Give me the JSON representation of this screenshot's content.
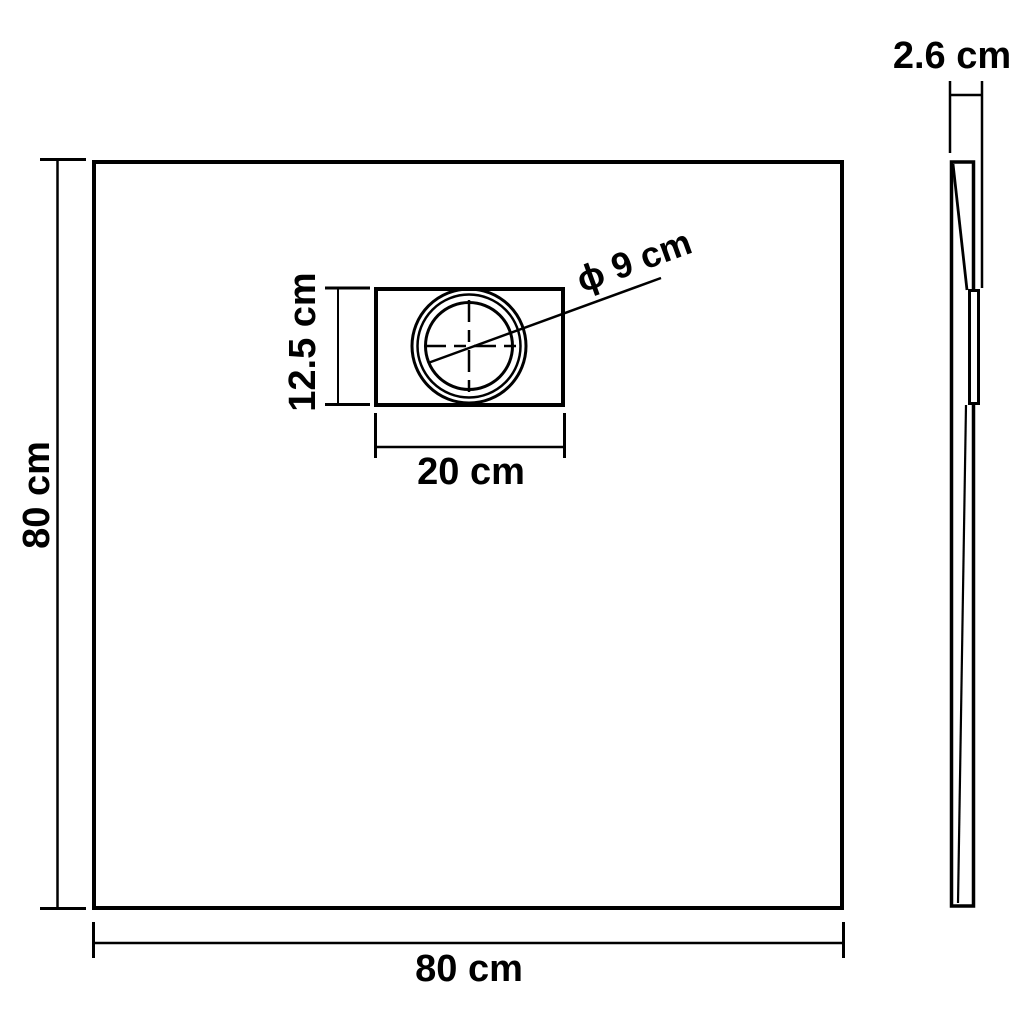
{
  "diagram": {
    "background_color": "#ffffff",
    "line_color": "#000000",
    "plan_view": {
      "width_label": "80 cm",
      "height_label": "80 cm",
      "drain_box": {
        "width_label": "20 cm",
        "height_label": "12.5 cm",
        "diameter_label": "ϕ 9 cm"
      }
    },
    "side_view": {
      "thickness_label": "2.6 cm"
    }
  }
}
